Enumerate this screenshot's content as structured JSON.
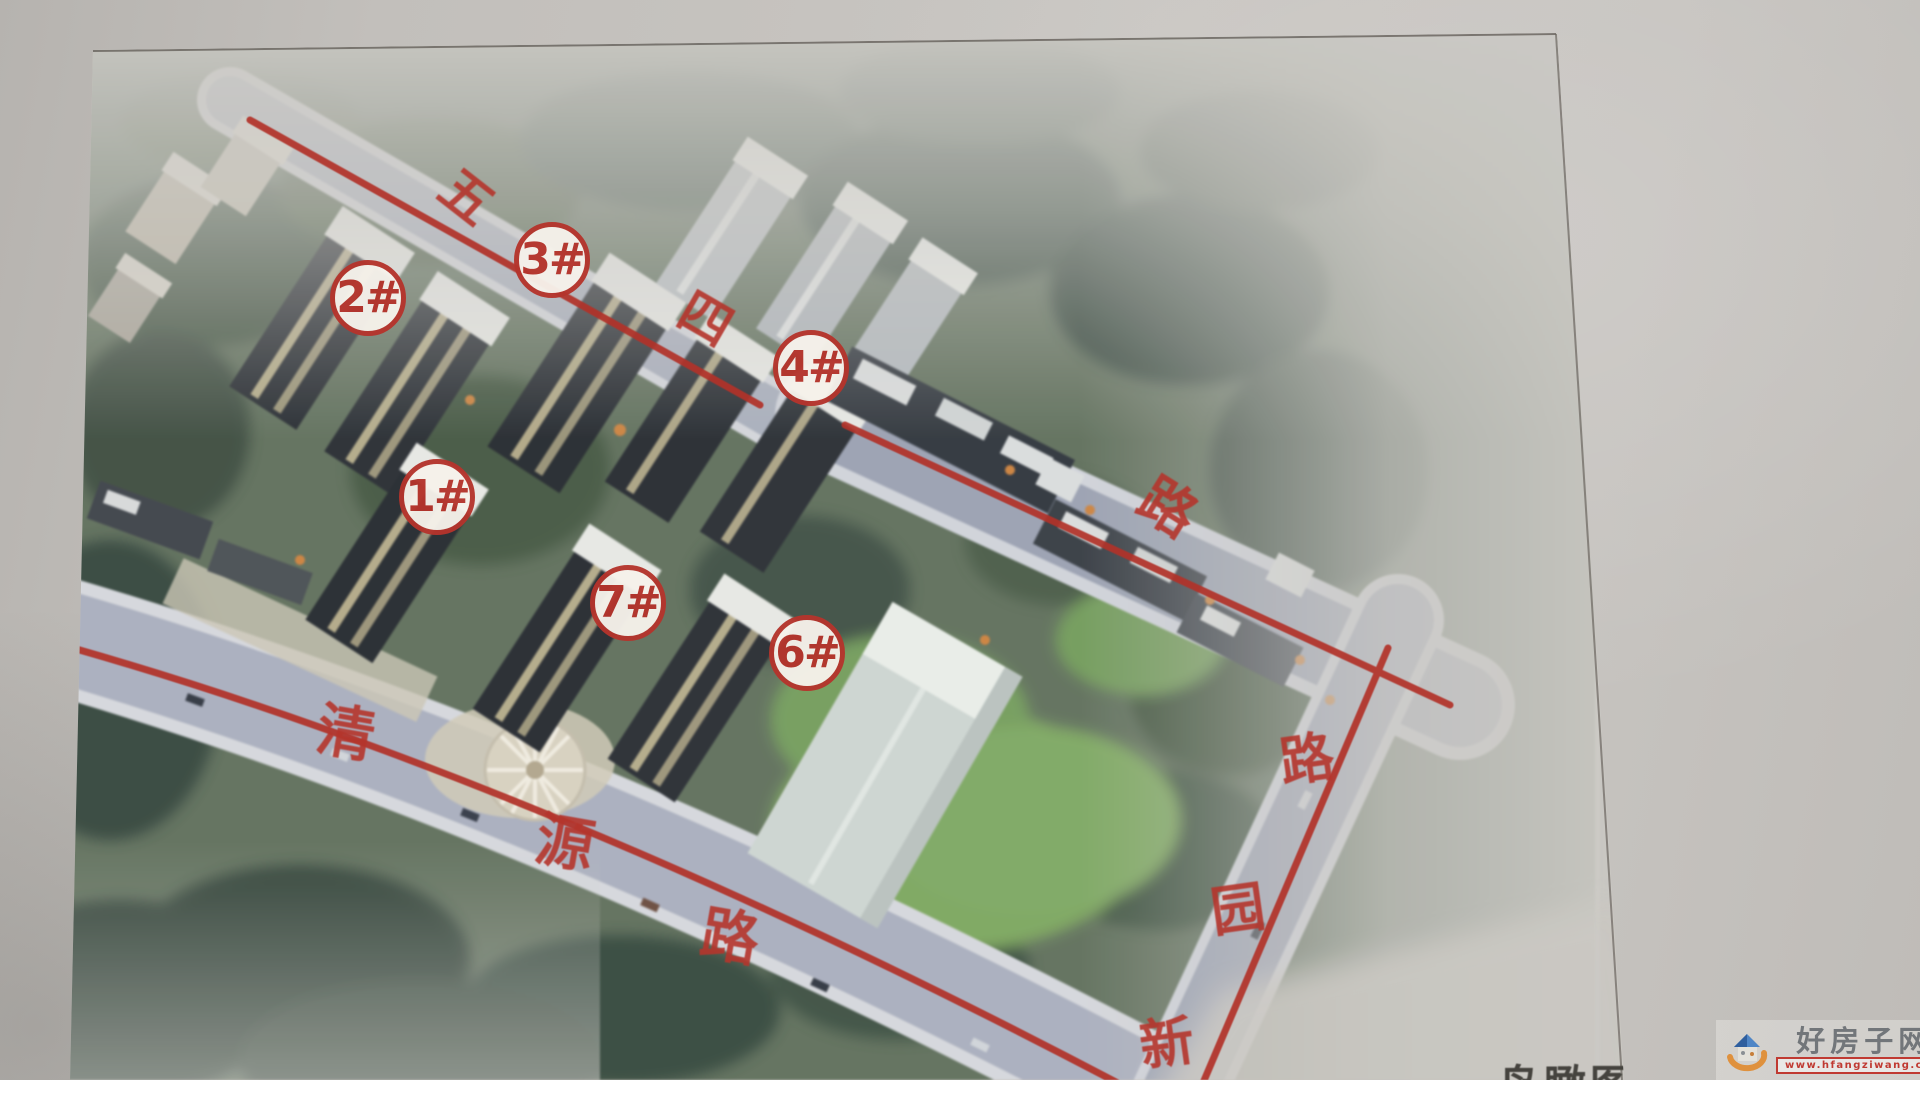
{
  "poster": {
    "caption": "鸟瞰图",
    "badges": [
      {
        "label": "1#",
        "x": 437,
        "y": 497
      },
      {
        "label": "2#",
        "x": 368,
        "y": 298
      },
      {
        "label": "3#",
        "x": 552,
        "y": 260
      },
      {
        "label": "4#",
        "x": 811,
        "y": 368
      },
      {
        "label": "6#",
        "x": 807,
        "y": 653
      },
      {
        "label": "7#",
        "x": 628,
        "y": 603
      }
    ],
    "roads": [
      {
        "name": "五四路",
        "chars": [
          {
            "ch": "五",
            "x": 466,
            "y": 198,
            "rot": 38,
            "size": 52
          },
          {
            "ch": "四",
            "x": 705,
            "y": 320,
            "rot": 30,
            "size": 52
          },
          {
            "ch": "路",
            "x": 1167,
            "y": 509,
            "rot": 32,
            "size": 56
          }
        ]
      },
      {
        "name": "清源路",
        "chars": [
          {
            "ch": "清",
            "x": 346,
            "y": 733,
            "rot": 10,
            "size": 58
          },
          {
            "ch": "源",
            "x": 565,
            "y": 843,
            "rot": 10,
            "size": 58
          },
          {
            "ch": "路",
            "x": 730,
            "y": 937,
            "rot": 10,
            "size": 58
          }
        ]
      },
      {
        "name": "新园路",
        "chars": [
          {
            "ch": "新",
            "x": 1167,
            "y": 1044,
            "rot": -8,
            "size": 54
          },
          {
            "ch": "园",
            "x": 1238,
            "y": 910,
            "rot": -8,
            "size": 54
          },
          {
            "ch": "路",
            "x": 1307,
            "y": 760,
            "rot": -8,
            "size": 54
          }
        ]
      }
    ]
  },
  "watermark": {
    "site_name": "好房子网",
    "url": "www.hfangziwang.com"
  }
}
